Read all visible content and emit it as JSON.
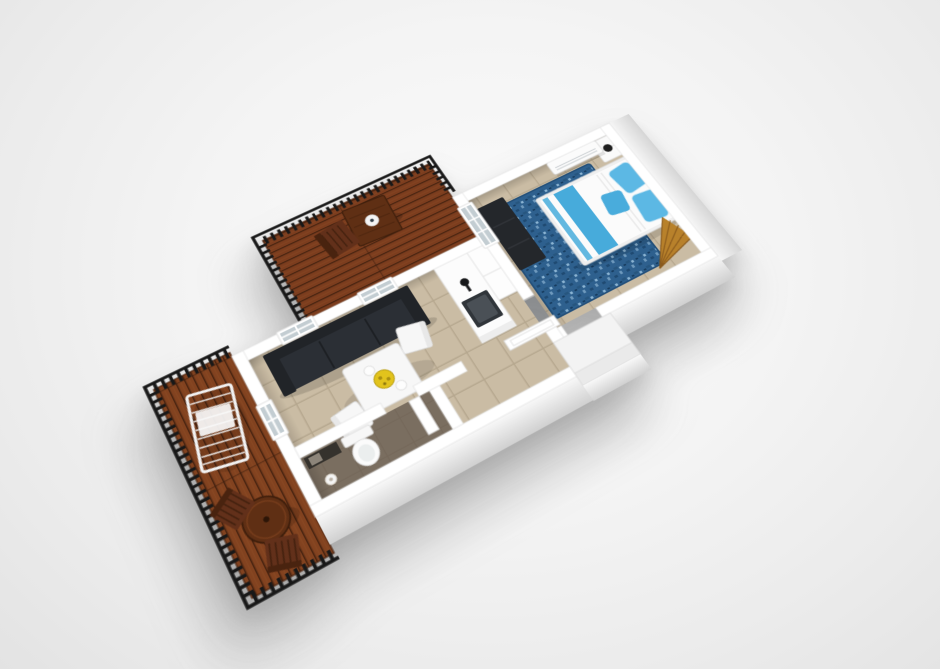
{
  "scene": {
    "type": "3d_floor_plan_render",
    "style": "isometric three-quarter aerial view, plan rotated about -30 degrees",
    "background": "plain light gray studio backdrop with soft cast shadow under the model"
  },
  "rooms": [
    {
      "id": "bedroom",
      "position": "east end",
      "furniture": [
        "double bed with white duvet and blue stripes",
        "two blue pillows",
        "small blue cushion",
        "wood slat headboard on east wall",
        "white nightstand with black lamp",
        "white air-conditioner unit on north wall",
        "dark media bench on west wall",
        "blue mottled rug",
        "wooden fan decor in south-east corner",
        "white french glass door to north balcony"
      ]
    },
    {
      "id": "living-kitchen",
      "position": "center-west",
      "furniture": [
        "long dark sofa along north wall",
        "two 2x2 windows on north wall",
        "window on west wall",
        "white square dining table",
        "two white chairs",
        "yellow fruit bowl",
        "two white plates",
        "kitchen counter with dark sink and black faucet",
        "tall white cabinet"
      ]
    },
    {
      "id": "bathroom",
      "position": "south-west strip",
      "furniture": [
        "white toilet",
        "dark vanity counter",
        "toilet paper roll on floor",
        "white door leaf"
      ]
    },
    {
      "id": "hallway",
      "position": "south-center strip",
      "furniture": [
        "open white entry door leaf"
      ]
    },
    {
      "id": "north-balcony",
      "position": "north of kitchen",
      "furniture": [
        "mahogany plank deck",
        "black baluster railing",
        "square wooden table",
        "white plate",
        "wooden chair"
      ]
    },
    {
      "id": "west-balcony",
      "position": "west end",
      "furniture": [
        "mahogany plank deck",
        "black baluster railing",
        "white sun lounger",
        "round wooden table",
        "two wooden chairs"
      ]
    },
    {
      "id": "entry-porch",
      "position": "south-east of hallway",
      "furniture": [
        "white step platform"
      ]
    }
  ],
  "colors": {
    "wall": "#ffffff",
    "wall_edge": "#e4e4e4",
    "tile_floor": "#cabca4",
    "bath_floor": "#7a6e60",
    "deck_wood": "#7c3d1e",
    "deck_wood_west": "#82421f",
    "railing": "#181818",
    "sofa_seat": "#2b2f35",
    "sofa_frame": "#212428",
    "dining_white": "#f7f7f7",
    "bowl_yellow": "#e2c31c",
    "counter_white": "#fcfcfc",
    "sink_dark": "#30353a",
    "faucet_black": "#17181a",
    "bed_white": "#fbfbfb",
    "bed_blue": "#47abdb",
    "pillow_blue": "#5cb8e4",
    "rug_blue": "#2e608e",
    "headboard_wood": "#b57a2e",
    "fan_wood": "#b8812b",
    "bench_dark": "#24272b",
    "table_wood": "#5f2f14",
    "chair_wood": "#62301a",
    "glass": "#c3cdd2",
    "lamp_black": "#1f1f1f",
    "porcelain": "#fafafa",
    "porch_white": "#f3f3f3"
  }
}
